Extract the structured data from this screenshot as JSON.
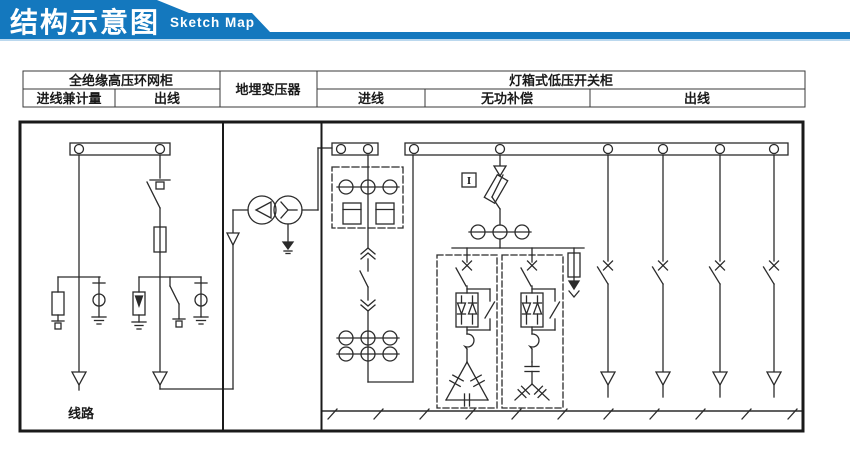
{
  "header": {
    "title": "结构示意图",
    "subtitle": "Sketch Map",
    "banner_color": "#1478BE",
    "banner_accent_color": "#BBD8EE"
  },
  "table": {
    "hv_cabinet": "全绝缘高压环网柜",
    "transformer": "地埋变压器",
    "lv_cabinet": "灯箱式低压开关柜",
    "hv_incoming": "进线兼计量",
    "hv_outgoing": "出线",
    "lv_incoming": "进线",
    "compensation": "无功补偿",
    "lv_outgoing": "出线"
  },
  "diagram": {
    "line_label": "线路",
    "indicator_letter": "I",
    "stroke_color": "#2b2b2b",
    "border_color": "#1a1a1a"
  }
}
